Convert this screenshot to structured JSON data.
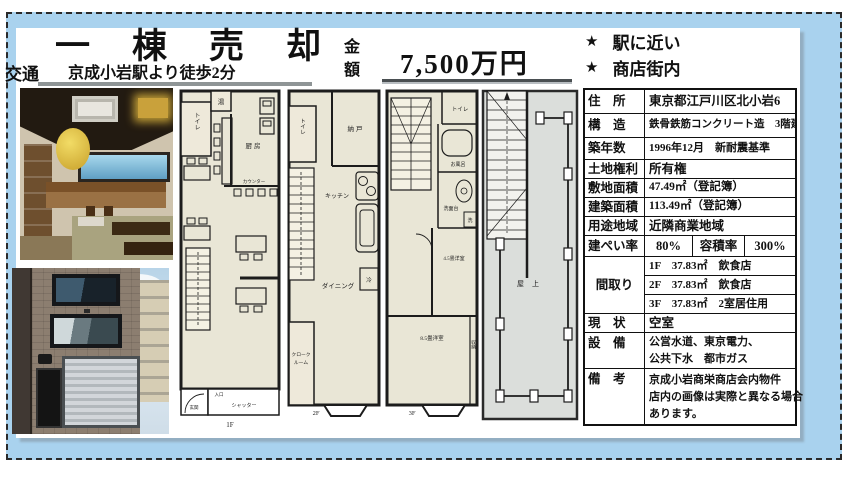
{
  "colors": {
    "band_blue": "#a9d2ee",
    "plan_beige": "#e9e6d6",
    "roof_grey": "#dbdedb"
  },
  "header": {
    "title": "一棟売却",
    "transport_label": "交通",
    "transport_value": "京成小岩駅より徒歩2分",
    "price_label_line1": "金",
    "price_label_line2": "額",
    "price_value": "7,500万円",
    "highlights": [
      {
        "bullet": "★",
        "text": "駅に近い"
      },
      {
        "bullet": "★",
        "text": "商店街内"
      }
    ]
  },
  "table": {
    "rows": [
      {
        "label": "住　所",
        "value": "東京都江戸川区北小岩6"
      },
      {
        "label": "構　造",
        "value": "鉄骨鉄筋コンクリート造　3階建"
      },
      {
        "label": "築年数",
        "value": "1996年12月　新耐震基準"
      },
      {
        "label": "土地権利",
        "value": "所有権"
      },
      {
        "label": "敷地面積",
        "value": "47.49㎡（登記簿）"
      },
      {
        "label": "建築面積",
        "value": "113.49㎡（登記簿）"
      },
      {
        "label": "用途地域",
        "value": "近隣商業地域"
      },
      {
        "label": "建ぺい率",
        "value": "80%",
        "label2": "容積率",
        "value2": "300%"
      },
      {
        "label": "間取り",
        "lines": [
          "1F　37.83㎡　飲食店",
          "2F　37.83㎡　飲食店",
          "3F　37.83㎡　2室居住用"
        ]
      },
      {
        "label": "現　状",
        "value": "空室"
      },
      {
        "label": "設　備",
        "lines": [
          "公営水道、東京電力、",
          "公共下水　都市ガス"
        ]
      },
      {
        "label": "備　考",
        "lines": [
          "京成小岩商栄商店会内物件",
          "店内の画像は実際と異なる場合",
          "あります。"
        ]
      }
    ]
  },
  "floorplans": {
    "f1": {
      "caption": "1F",
      "toilet": "トイレ",
      "bath_heater": "湯",
      "kitchen": "厨房",
      "counter": "カウンター",
      "entrance": "入口",
      "foyer": "玄関",
      "shutter": "シャッター"
    },
    "f2": {
      "caption": "2F",
      "toilet": "トイレ",
      "storeroom": "納戸",
      "kitchen": "キッチン",
      "fridge": "冷",
      "dining": "ダイニング",
      "cloak_line1": "クローク",
      "cloak_line2": "ルーム"
    },
    "f3": {
      "caption": "3F",
      "toilet": "トイレ",
      "bath": "お風呂",
      "vanity": "洗面台",
      "laundry": "洗",
      "room_small": "4.5畳洋室",
      "room_large": "8.5畳洋室",
      "closet": "収納"
    },
    "roof": {
      "label": "屋上"
    }
  }
}
